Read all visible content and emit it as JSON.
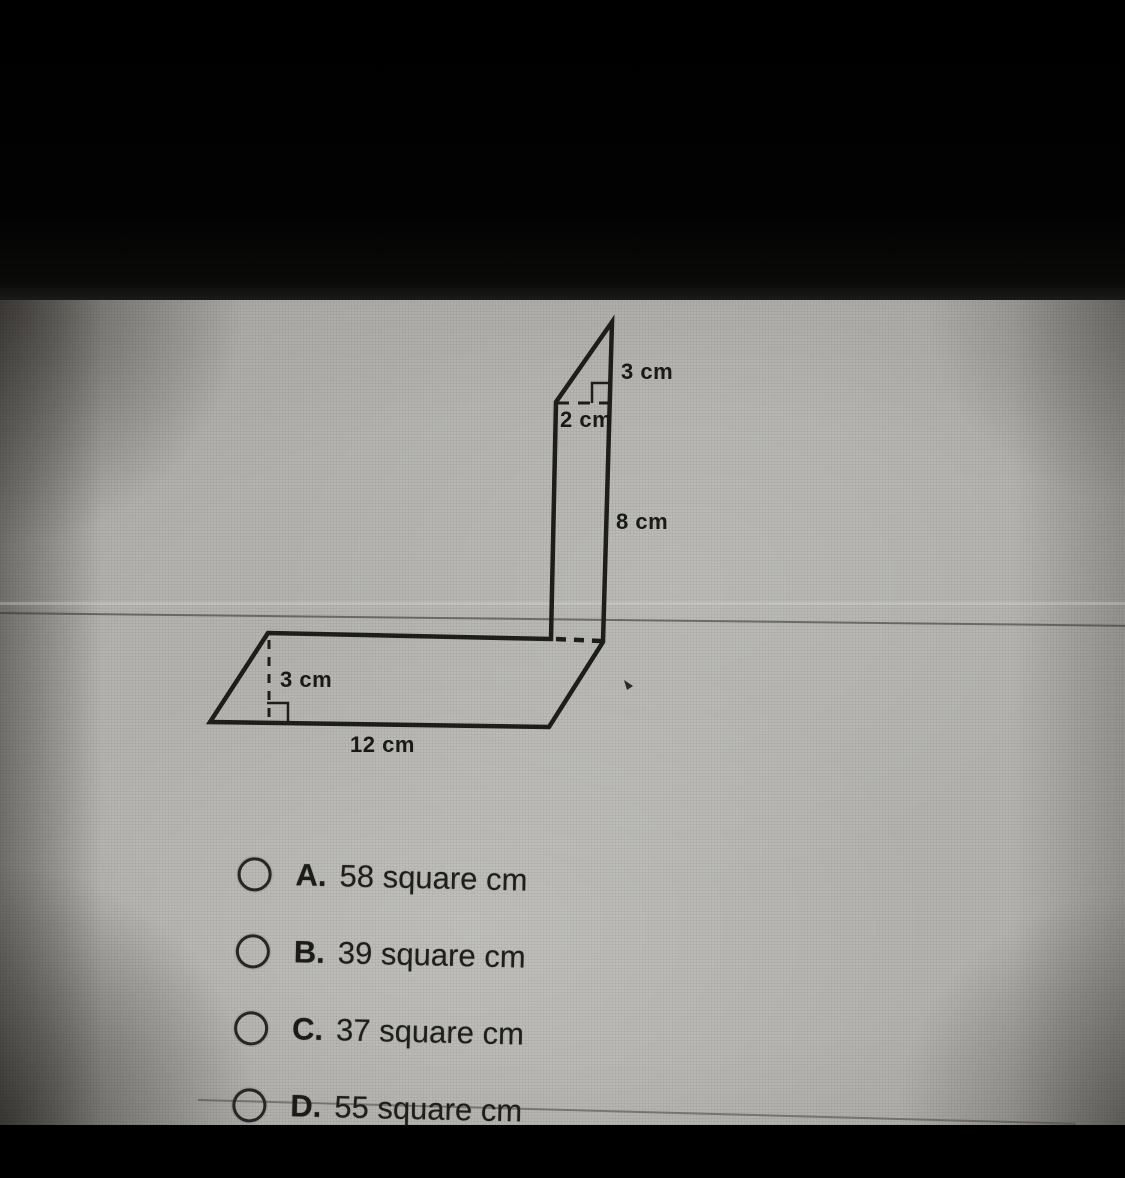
{
  "figure": {
    "labels": {
      "slant_top": "3 cm",
      "width_top": "2 cm",
      "side_right": "8 cm",
      "height_bottom": "3 cm",
      "base_bottom": "12 cm"
    }
  },
  "options": [
    {
      "letter": "A.",
      "text": "58 square cm"
    },
    {
      "letter": "B.",
      "text": "39 square cm"
    },
    {
      "letter": "C.",
      "text": "37 square cm"
    },
    {
      "letter": "D.",
      "text": "55 square cm"
    }
  ],
  "colors": {
    "ink": "#1d1d1b",
    "screen_gray": "#b5b4b0",
    "top_bar": "#000000"
  }
}
